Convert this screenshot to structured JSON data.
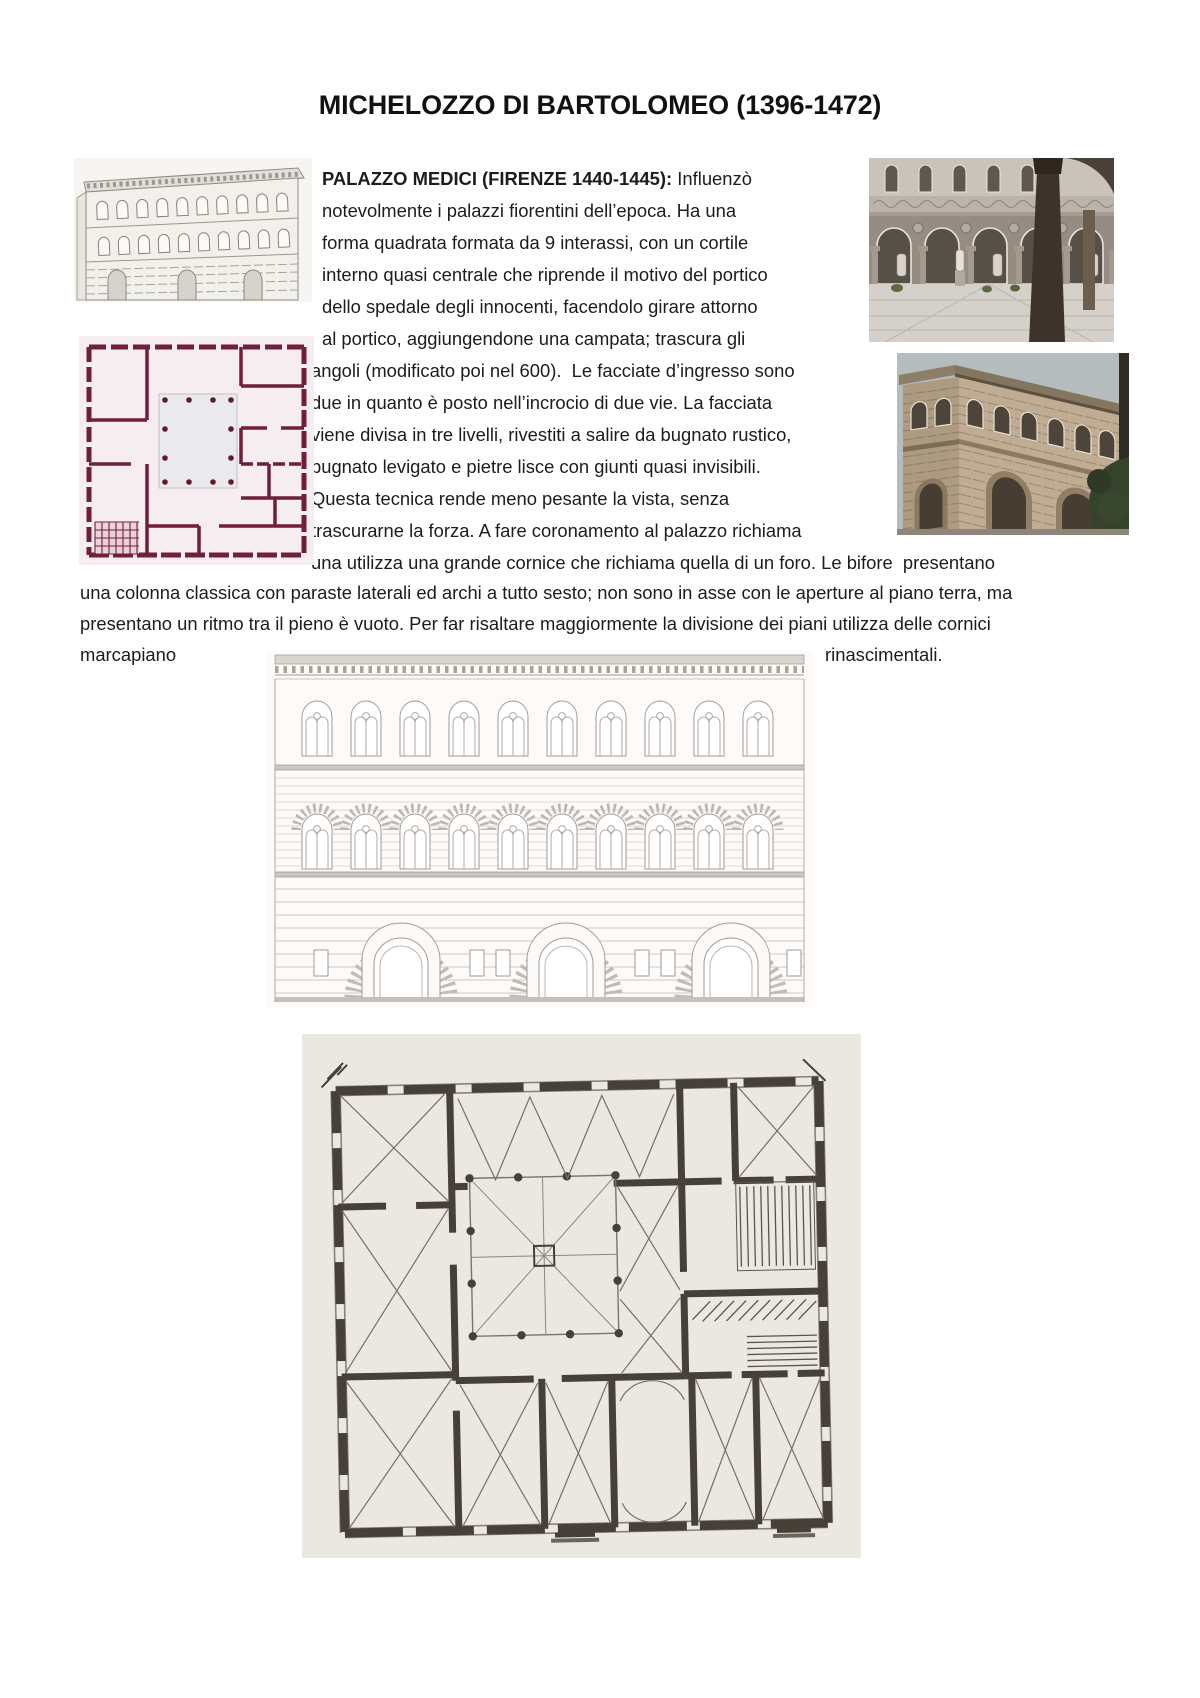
{
  "document": {
    "title": "MICHELOZZO DI BARTOLOMEO (1396-1472)"
  },
  "paragraph": {
    "heading": "PALAZZO MEDICI (FIRENZE 1440-1445):",
    "heading_tail": " Influenzò",
    "lines": [
      "notevolmente i palazzi fiorentini dell’epoca. Ha una",
      "forma quadrata formata da 9 interassi, con un cortile",
      "interno quasi centrale che riprende il motivo del portico",
      "dello spedale degli innocenti, facendolo girare attorno",
      "al portico, aggiungendone una campata; trascura gli",
      "angoli (modificato poi nel 600).  Le facciate d’ingresso sono",
      "due in quanto è posto nell’incrocio di due vie. La facciata",
      "viene divisa in tre livelli, rivestiti a salire da bugnato rustico,",
      "bugnato levigato e pietre lisce con giunti quasi invisibili.",
      "Questa tecnica rende meno pesante la vista, senza",
      "trascurarne la forza. A fare coronamento al palazzo richiama",
      "una utilizza una grande cornice che richiama quella di un foro. Le bifore  presentano",
      "una colonna classica con paraste laterali ed archi a tutto sesto; non sono in asse con le aperture al piano terra, ma",
      "presentano un ritmo tra il pieno è vuoto. Per far risaltare maggiormente la divisione dei piani utilizza delle cornici",
      "marcapiano",
      "rinascimentali."
    ]
  },
  "figures": {
    "sketch": "palazzo-medici-exterior-engraving",
    "courtyard": "palazzo-medici-courtyard-photo",
    "pink_plan": "palazzo-medici-floor-plan-drawing",
    "corner": "palazzo-medici-street-corner-photo",
    "facade": "palazzo-medici-facade-elevation-drawing",
    "ground_plan": "palazzo-medici-ground-floor-plan-scan"
  },
  "colors": {
    "text": "#1c1c1c",
    "pink_plan_ink": "#6f2036",
    "ground_plan_ink": "#474039",
    "facade_ink": "#a39a93"
  }
}
